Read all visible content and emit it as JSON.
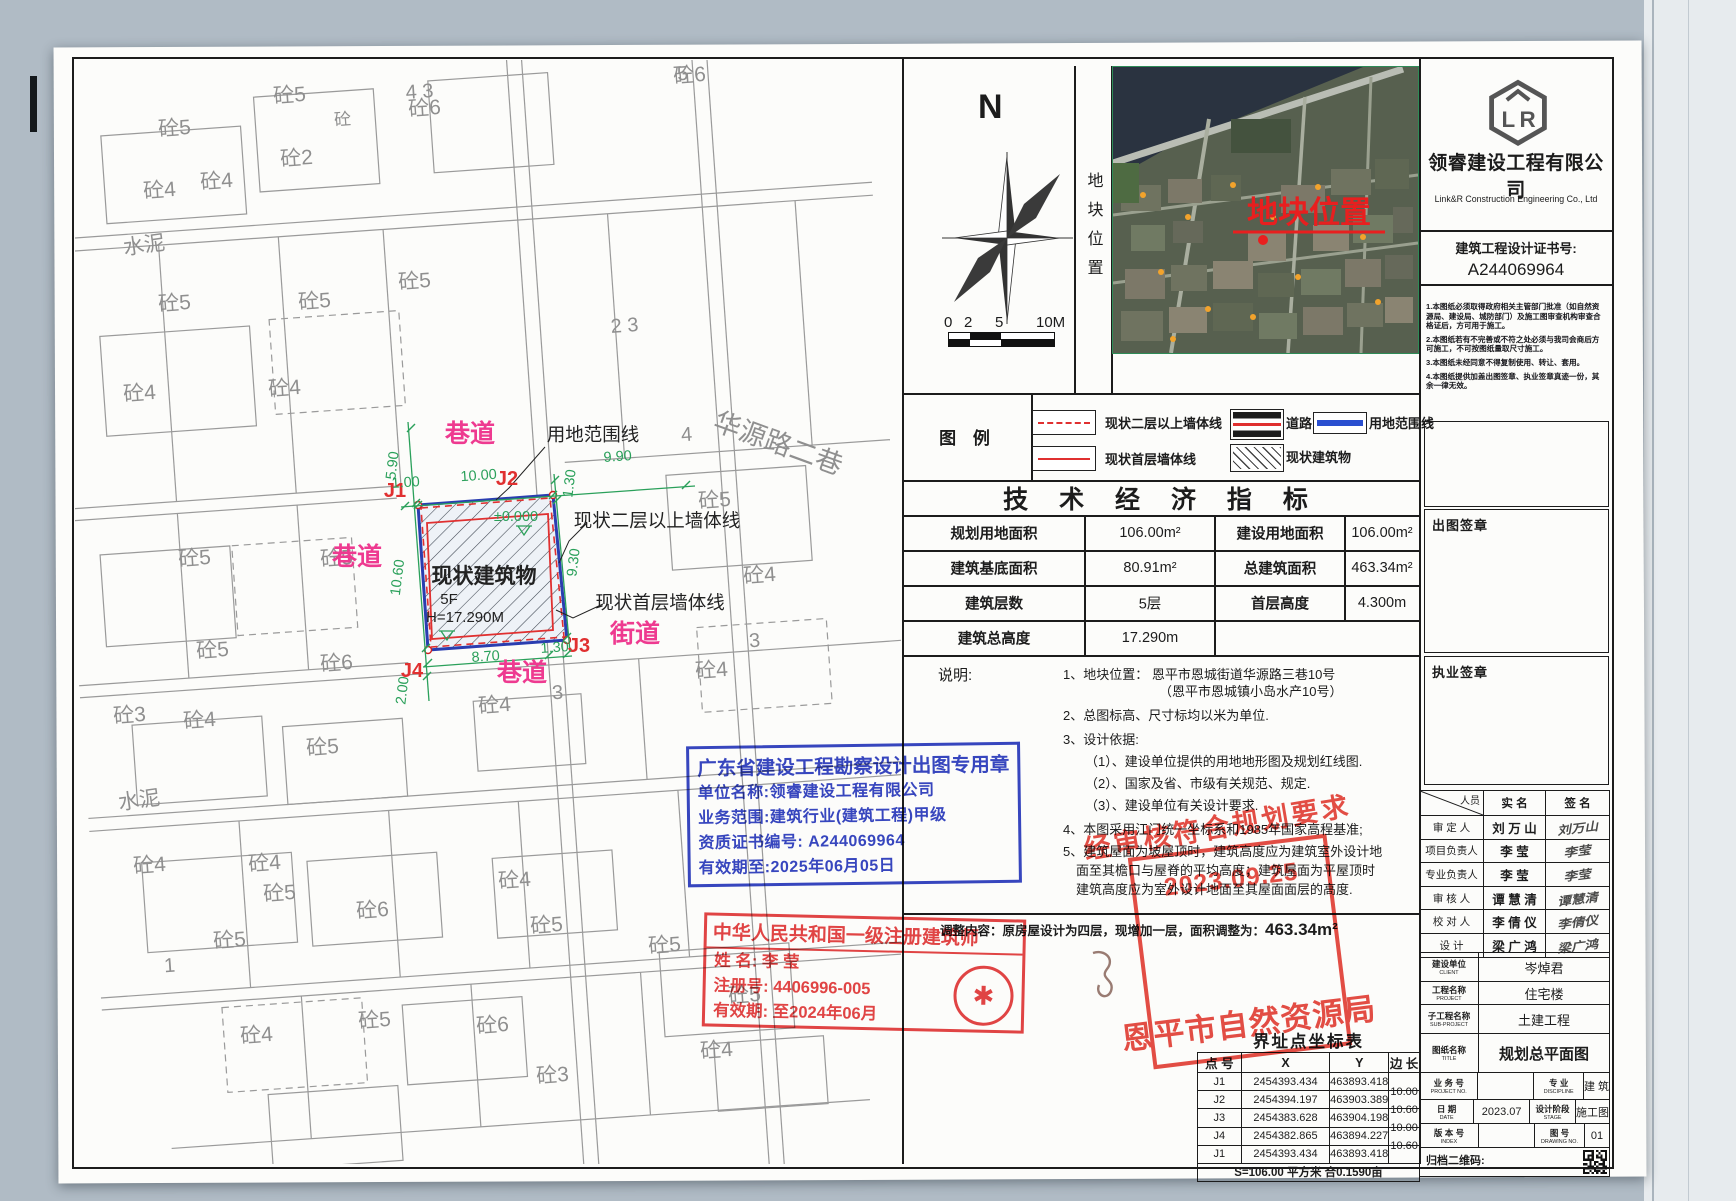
{
  "colors": {
    "accent_pink": "#ee3a90",
    "dim_green": "#2aa05a",
    "boundary_blue": "#2a3db0",
    "stamp_red": "#e03030",
    "stamp_blue": "#2637bd"
  },
  "site_plan": {
    "road_labels": [
      {
        "text": "巷道",
        "x": 395,
        "y": 382
      },
      {
        "text": "巷道",
        "x": 282,
        "y": 505
      },
      {
        "text": "巷道",
        "x": 447,
        "y": 621
      },
      {
        "text": "街道",
        "x": 560,
        "y": 582
      }
    ],
    "callouts": [
      {
        "text": "用地范围线",
        "x": 518,
        "y": 381
      },
      {
        "text": "现状二层以上墙体线",
        "x": 582,
        "y": 467
      },
      {
        "text": "现状首层墙体线",
        "x": 585,
        "y": 549
      }
    ],
    "points": [
      {
        "text": "J1",
        "x": 320,
        "y": 437
      },
      {
        "text": "J2",
        "x": 432,
        "y": 425
      },
      {
        "text": "J3",
        "x": 504,
        "y": 592
      },
      {
        "text": "J4",
        "x": 337,
        "y": 617
      }
    ],
    "building": {
      "name": "现状建筑物",
      "x": 409,
      "y": 523,
      "floors": "5F",
      "fx": 374,
      "fy": 544,
      "height": "H=17.290M",
      "hx": 390,
      "hy": 562,
      "level": "±0.000",
      "lx": 441,
      "ly": 461
    },
    "dims": [
      {
        "v": "5.90",
        "x": 322,
        "y": 406,
        "r": -83
      },
      {
        "v": "1.00",
        "x": 331,
        "y": 427,
        "r": -4
      },
      {
        "v": "10.00",
        "x": 404,
        "y": 420,
        "r": -4
      },
      {
        "v": "9.90",
        "x": 543,
        "y": 401,
        "r": -4
      },
      {
        "v": "1.30",
        "x": 499,
        "y": 424,
        "r": -83
      },
      {
        "v": "10.60",
        "x": 327,
        "y": 518,
        "r": -83
      },
      {
        "v": "9.30",
        "x": 503,
        "y": 503,
        "r": -83
      },
      {
        "v": "8.70",
        "x": 411,
        "y": 601,
        "r": -4
      },
      {
        "v": "1.30",
        "x": 480,
        "y": 592,
        "r": -4
      },
      {
        "v": "2.00",
        "x": 332,
        "y": 631,
        "r": -83
      }
    ],
    "plots": [
      {
        "t": "砼5",
        "x": 100,
        "y": 75
      },
      {
        "t": "砼5",
        "x": 215,
        "y": 42
      },
      {
        "t": "砼6",
        "x": 350,
        "y": 55
      },
      {
        "t": "砼",
        "x": 268,
        "y": 65,
        "s": 17
      },
      {
        "t": "砼6",
        "x": 615,
        "y": 22
      },
      {
        "t": "5",
        "x": 608,
        "y": 20,
        "s": 20
      },
      {
        "t": "砼4",
        "x": 85,
        "y": 137
      },
      {
        "t": "砼4",
        "x": 142,
        "y": 128
      },
      {
        "t": "砼2",
        "x": 222,
        "y": 105
      },
      {
        "t": "水泥",
        "x": 70,
        "y": 192,
        "r": -8
      },
      {
        "t": "砼5",
        "x": 100,
        "y": 250
      },
      {
        "t": "砼5",
        "x": 240,
        "y": 248
      },
      {
        "t": "砼5",
        "x": 340,
        "y": 228
      },
      {
        "t": "砼4",
        "x": 65,
        "y": 340
      },
      {
        "t": "砼4",
        "x": 210,
        "y": 335
      },
      {
        "t": "4 3",
        "x": 345,
        "y": 38,
        "s": 20
      },
      {
        "t": "2 3",
        "x": 550,
        "y": 272,
        "s": 20
      },
      {
        "t": "砼5",
        "x": 120,
        "y": 505
      },
      {
        "t": "砼5",
        "x": 262,
        "y": 505
      },
      {
        "t": "砼5",
        "x": 640,
        "y": 447
      },
      {
        "t": "4",
        "x": 612,
        "y": 381,
        "s": 20
      },
      {
        "t": "砼4",
        "x": 685,
        "y": 522
      },
      {
        "t": "3",
        "x": 680,
        "y": 587,
        "s": 20
      },
      {
        "t": "华源路二巷",
        "x": 700,
        "y": 392,
        "s": 27,
        "r": 20
      },
      {
        "t": "砼5",
        "x": 138,
        "y": 597
      },
      {
        "t": "砼6",
        "x": 262,
        "y": 610
      },
      {
        "t": "砼4",
        "x": 420,
        "y": 652
      },
      {
        "t": "3",
        "x": 483,
        "y": 639,
        "s": 20
      },
      {
        "t": "砼3",
        "x": 55,
        "y": 662
      },
      {
        "t": "砼4",
        "x": 125,
        "y": 667
      },
      {
        "t": "砼5",
        "x": 248,
        "y": 694
      },
      {
        "t": "砼4",
        "x": 637,
        "y": 617
      },
      {
        "t": "水泥",
        "x": 65,
        "y": 747,
        "r": -8
      },
      {
        "t": "砼4",
        "x": 75,
        "y": 812
      },
      {
        "t": "砼4",
        "x": 190,
        "y": 810
      },
      {
        "t": "砼5",
        "x": 205,
        "y": 840
      },
      {
        "t": "砼6",
        "x": 298,
        "y": 857
      },
      {
        "t": "砼4",
        "x": 440,
        "y": 827
      },
      {
        "t": "砼5",
        "x": 472,
        "y": 872
      },
      {
        "t": "砼5",
        "x": 155,
        "y": 887
      },
      {
        "t": "1",
        "x": 95,
        "y": 912,
        "s": 20
      },
      {
        "t": "砼4",
        "x": 182,
        "y": 982
      },
      {
        "t": "砼5",
        "x": 300,
        "y": 967
      },
      {
        "t": "砼6",
        "x": 418,
        "y": 972
      },
      {
        "t": "砼5",
        "x": 670,
        "y": 942
      },
      {
        "t": "砼4",
        "x": 642,
        "y": 997
      },
      {
        "t": "砼3",
        "x": 478,
        "y": 1022
      },
      {
        "t": "砼5",
        "x": 590,
        "y": 892
      }
    ]
  },
  "compass": {
    "label": "N"
  },
  "scalebar": {
    "labels": [
      "0",
      "2",
      "5",
      "10M"
    ]
  },
  "strip": {
    "text": "地块位置"
  },
  "satellite": {
    "label": "地块位置"
  },
  "company": {
    "name": "领睿建设工程有限公司",
    "en": "Link&R Construction Engineering Co., Ltd",
    "cert_label": "建筑工程设计证书号:",
    "cert_no": "A244069964"
  },
  "side_notes": [
    "1.本图纸必须取得政府相关主管部门批准（如自然资源局、建设局、城防部门）及施工图审查机构审查合格证后，方可用于施工。",
    "2.本图纸若有不完善或不符之处必须与我司会商后方可施工，不可按图纸量取尺寸施工。",
    "3.本图纸未经同意不得复制使用、转让、套用。",
    "4.本图纸提供加盖出图签章、执业签章真迹一份，其余一律无效。"
  ],
  "sign_boxes": {
    "chutu": "出图签章",
    "zhiye": "执业签章"
  },
  "legend": {
    "title": "图  例",
    "items": [
      {
        "label": "现状二层以上墙体线",
        "type": "red-dashed"
      },
      {
        "label": "现状首层墙体线",
        "type": "red-solid"
      },
      {
        "label": "道路",
        "type": "road"
      },
      {
        "label": "用地范围线",
        "type": "blue-line"
      },
      {
        "label": "现状建筑物",
        "type": "hatch"
      }
    ]
  },
  "indicators": {
    "title": "技 术 经 济 指 标",
    "rows": [
      [
        "规划用地面积",
        "106.00m²",
        "建设用地面积",
        "106.00m²"
      ],
      [
        "建筑基底面积",
        "80.91m²",
        "总建筑面积",
        "463.34m²"
      ],
      [
        "建筑层数",
        "5层",
        "首层高度",
        "4.300m"
      ],
      [
        "建筑总高度",
        "17.290m",
        "",
        ""
      ]
    ]
  },
  "notes": {
    "label": "说明:",
    "lines": [
      {
        "t": "1、地块位置：  恩平市恩城街道华源路三巷10号",
        "ind": 0,
        "mt": 0
      },
      {
        "t": "（恩平市恩城镇小岛水产10号）",
        "ind": 96,
        "mt": 0
      },
      {
        "t": "2、总图标高、尺寸标均以米为单位.",
        "ind": 0,
        "mt": 7
      },
      {
        "t": "3、设计依据:",
        "ind": 0,
        "mt": 7
      },
      {
        "t": "（1）、建设单位提供的用地地形图及规划红线图.",
        "ind": 22,
        "mt": 5
      },
      {
        "t": "（2）、国家及省、市级有关规范、规定.",
        "ind": 22,
        "mt": 5
      },
      {
        "t": "（3）、建设单位有关设计要求.",
        "ind": 22,
        "mt": 5
      },
      {
        "t": "4、本图采用江门统一坐标系和1985年国家高程基准;",
        "ind": 0,
        "mt": 7
      },
      {
        "t": "5、建筑屋面为坡屋顶时，建筑高度应为建筑室外设计地",
        "ind": 0,
        "mt": 5
      },
      {
        "t": "面至其檐口与屋脊的平均高度；建筑屋面为平屋顶时",
        "ind": 13,
        "mt": 2
      },
      {
        "t": "建筑高度应为室外设计地面至其屋面面层的高度.",
        "ind": 13,
        "mt": 2
      }
    ]
  },
  "adjustment": {
    "prefix": "调整内容：原房屋设计为四层，现增加一层，面积调整为：",
    "value": "463.34m²"
  },
  "blue_stamp": {
    "title": "广东省建设工程勘察设计出图专用章",
    "lines": [
      "单位名称:领睿建设工程有限公司",
      "业务范围:建筑行业(建筑工程)甲级",
      "资质证书编号: A244069964",
      "有效期至:2025年06月05日"
    ]
  },
  "red_stamp": {
    "title": "中华人民共和国一级注册建筑师",
    "rows": [
      "姓   名:      李   莹",
      "注册号:  4406996-005",
      "有效期:  至2024年06月"
    ]
  },
  "approval_stamp": {
    "slogan": "经审核符合规划要求",
    "date": "2023.09.25",
    "org": "恩平市自然资源局"
  },
  "personnel": {
    "header": [
      "人员",
      "实   名",
      "签   名"
    ],
    "rows": [
      {
        "role": "审 定 人",
        "name": "刘 万 山",
        "sig": "刘万山"
      },
      {
        "role": "项目负责人",
        "name": "李   莹",
        "sig": "李莹"
      },
      {
        "role": "专业负责人",
        "name": "李   莹",
        "sig": "李莹"
      },
      {
        "role": "审 核 人",
        "name": "谭 慧 清",
        "sig": "谭慧清"
      },
      {
        "role": "校 对 人",
        "name": "李 倩 仪",
        "sig": "李倩仪"
      },
      {
        "role": "设   计",
        "name": "梁 广 鸿",
        "sig": "梁广鸿"
      }
    ]
  },
  "title_block": {
    "rows": [
      {
        "cn": "建设单位",
        "en": "CLIENT",
        "value": "岑焯君"
      },
      {
        "cn": "工程名称",
        "en": "PROJECT",
        "value": "住宅楼"
      },
      {
        "cn": "子工程名称",
        "en": "SUB-PROJECT",
        "value": "土建工程"
      },
      {
        "cn": "图纸名称",
        "en": "TITLE",
        "value": "规划总平面图"
      }
    ],
    "grid": [
      {
        "cn": "业 务 号",
        "en": "PROJECT NO.",
        "value": "",
        "cn2": "专  业",
        "en2": "DISCIPLINE",
        "value2": "建 筑"
      },
      {
        "cn": "日  期",
        "en": "DATE",
        "value": "2023.07",
        "cn2": "设计阶段",
        "en2": "STAGE",
        "value2": "施工图"
      },
      {
        "cn": "版 本 号",
        "en": "INDEX",
        "value": "",
        "cn2": "图  号",
        "en2": "DRAWING NO.",
        "value2": "01"
      }
    ],
    "qr_label": "归档二维码:"
  },
  "coord_table": {
    "title": "界址点坐标表",
    "headers": [
      "点 号",
      "X",
      "Y",
      "边 长"
    ],
    "rows": [
      [
        "J1",
        "2454393.434",
        "463893.418",
        ""
      ],
      [
        "J2",
        "2454394.197",
        "463903.389",
        "10.00"
      ],
      [
        "J3",
        "2454383.628",
        "463904.198",
        "10.60"
      ],
      [
        "J4",
        "2454382.865",
        "463894.227",
        "10.00"
      ],
      [
        "J1",
        "2454393.434",
        "463893.418",
        "10.60"
      ]
    ],
    "footer": "S=106.00 平方米 合0.1590亩"
  }
}
